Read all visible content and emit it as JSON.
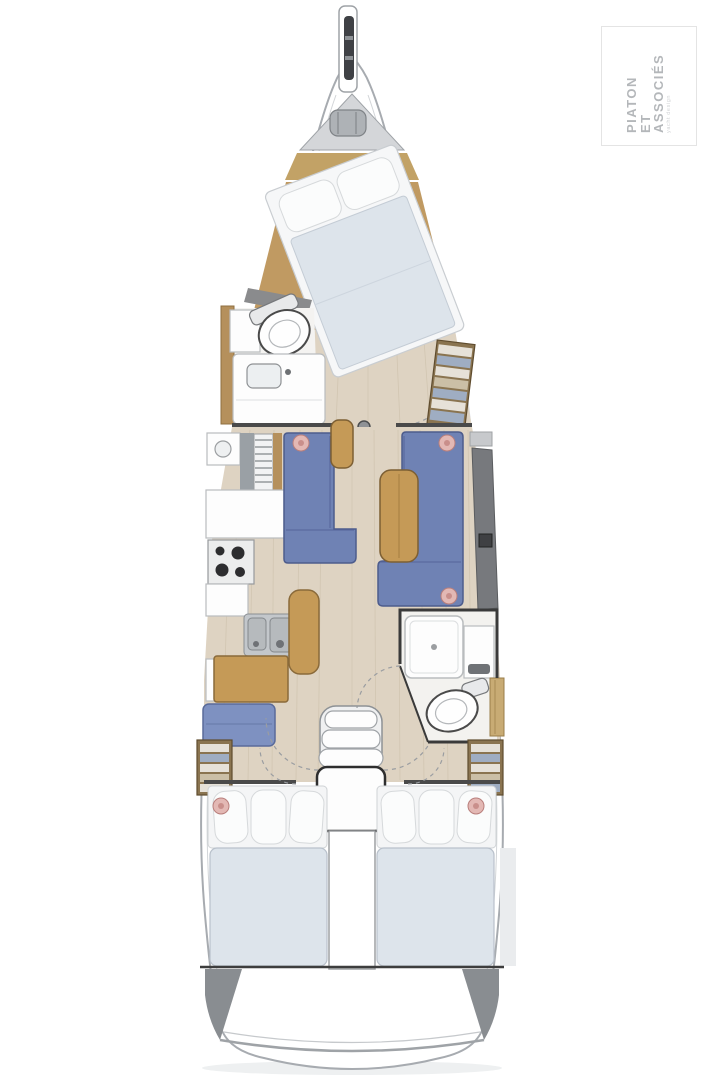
{
  "page": {
    "title": "sailing-yacht-interior-deck-plan",
    "background": "#ffffff"
  },
  "logo": {
    "line1": "PIATON",
    "line2": "ET",
    "line3": "ASSOCIÉS",
    "tagline": "yacht design",
    "text_color": "#b4b7ba",
    "border_color": "#e4e4e4"
  },
  "palette": {
    "hull_stroke": "#a7abb0",
    "deck_white": "#ffffff",
    "deck_line": "#d2d5d8",
    "side_strip": "#b2bcc8",
    "side_strip_dark": "#99a3af",
    "floor_light": "#ded3c2",
    "floor_line": "#cbbfa9",
    "floor_tan": "#c09a62",
    "bow_band_tan": "#c2a266",
    "bulkhead": "#4a4a4a",
    "wall_gray": "#8a8b8d",
    "sofa_blue": "#6f82b4",
    "sofa_blue_dark": "#4d5c8c",
    "seat_blue": "#7e91c1",
    "wood": "#c59a57",
    "wood_dark": "#7d5f33",
    "mattress": "#dde4eb",
    "mattress_line": "#c4ccd5",
    "pillow": "#fbfcfc",
    "fixture_white": "#fdfdfd",
    "fixture_stroke": "#4a4a4a",
    "steel": "#c3c7cb",
    "burner": "#2d2d2f",
    "accent_dot": "#e3b8b4",
    "shelf_blue": "#9fadc2",
    "cabinet_gray": "#77797d",
    "transom_gray": "#898d91",
    "anchor_locker_gray": "#d4d6d9",
    "windlass_gray": "#aeb2b6"
  },
  "areas": [
    "bowsprit",
    "anchor-locker",
    "owner-cabin-forward",
    "forward-head",
    "wardrobe-starboard",
    "galley-port",
    "dinette-sofa-port",
    "sofa-starboard",
    "salon-table",
    "nav-station-port",
    "companionway-steps",
    "aft-head-starboard",
    "aft-cabin-port",
    "aft-cabin-starboard",
    "transom"
  ]
}
